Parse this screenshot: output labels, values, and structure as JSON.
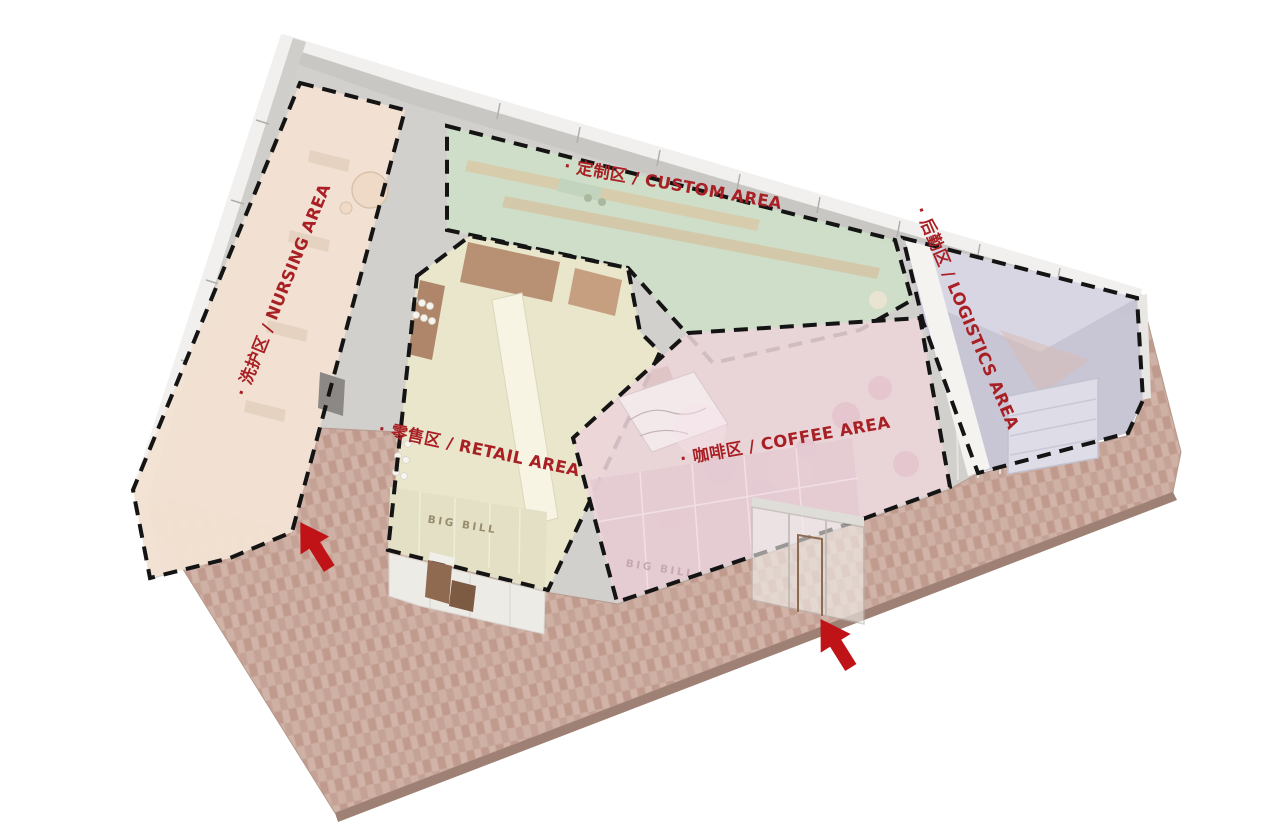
{
  "diagram": {
    "zones": {
      "nursing": {
        "label": "· 洗护区 / NURSING AREA"
      },
      "custom": {
        "label": "· 定制区 / CUSTOM AREA"
      },
      "retail": {
        "label": "· 零售区 / RETAIL AREA"
      },
      "coffee": {
        "label": "· 咖啡区 / COFFEE AREA"
      },
      "logistics": {
        "label": "· 后勤区 / LOGISTICS AREA"
      }
    },
    "signs": {
      "retail": "BIG BILL",
      "coffee": "BIG BILL"
    },
    "colors": {
      "label_red": "#a81f24",
      "arrow_red": "#bf1318",
      "nursing_beige": "#f3e2d2",
      "custom_green": "#cddfc8",
      "retail_khaki": "#e9e6cb",
      "coffee_pink": "#ecd4da",
      "logistics_lavender": "#c7c4d6",
      "plaza_brick": "#c9a89c",
      "dash_black": "#141414"
    }
  }
}
